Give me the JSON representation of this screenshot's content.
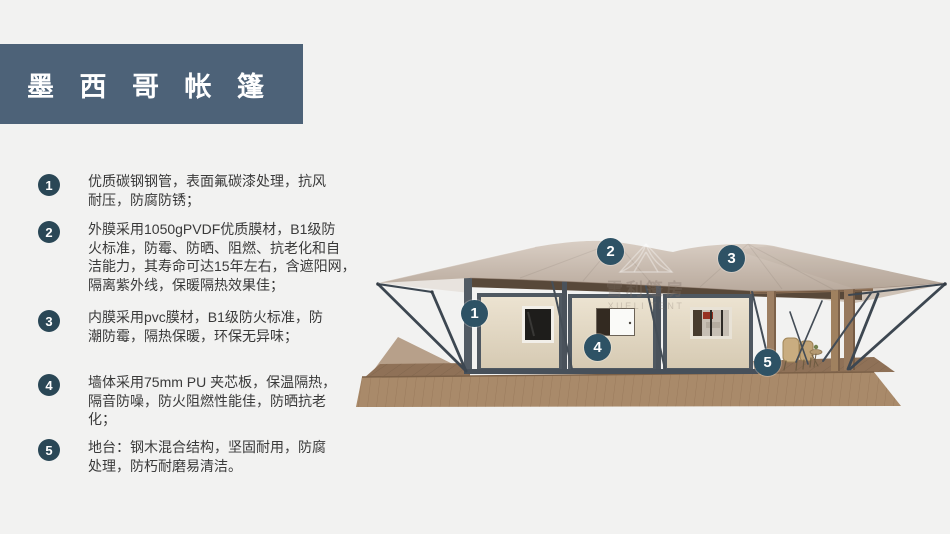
{
  "banner": {
    "title": "墨 西 哥 帐 篷",
    "bg_color": "#4d6278"
  },
  "features": [
    {
      "num": "1",
      "text": "优质碳钢钢管，表面氟碳漆处理，抗风\n耐压，防腐防锈；"
    },
    {
      "num": "2",
      "text": "外膜采用1050gPVDF优质膜材，B1级防\n火标准，防霉、防晒、阻燃、抗老化和自\n洁能力，其寿命可达15年左右，含遮阳网，\n隔离紫外线，保暖隔热效果佳；"
    },
    {
      "num": "3",
      "text": "内膜采用pvc膜材，B1级防火标准，防\n潮防霉，隔热保暖，环保无异味；"
    },
    {
      "num": "4",
      "text": "墙体采用75mm PU 夹芯板，保温隔热，\n隔音防噪，防火阻燃性能佳，防晒抗老\n化；"
    },
    {
      "num": "5",
      "text": "地台：钢木混合结构，坚固耐用，防腐\n处理，防朽耐磨易清洁。"
    }
  ],
  "watermark": {
    "cn": "雪利篷房",
    "en": "XUELI TENT"
  },
  "icons": [
    "tent-logo-icon"
  ],
  "colors": {
    "background": "#f2f2f1",
    "banner_bg": "#4d6278",
    "feature_badge": "#2a4756",
    "callout_badge": "#2e5265",
    "body_text": "#3a3a3a",
    "roof_light": "#d7ccc2",
    "roof_dark": "#b9aa9d",
    "wall_cream": "#e7ddc9",
    "frame_steel": "#4f5861",
    "deck_wood": "#a98a6a",
    "post_wood": "#9c7d60"
  }
}
